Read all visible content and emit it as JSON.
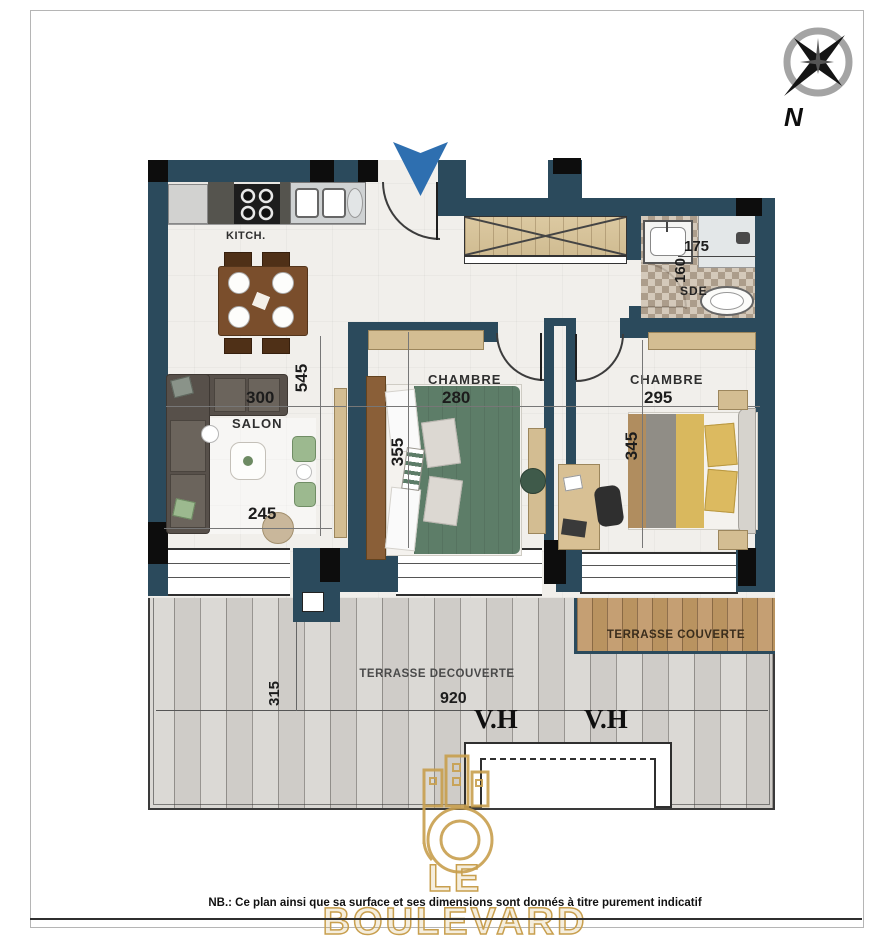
{
  "compass": {
    "north_label": "N"
  },
  "rooms": {
    "kitchen": {
      "label": "KITCH."
    },
    "salon": {
      "label": "SALON",
      "width": "300",
      "front": "245",
      "depth": "545"
    },
    "chambre1": {
      "label": "CHAMBRE",
      "width": "280",
      "depth": "355"
    },
    "chambre2": {
      "label": "CHAMBRE",
      "width": "295",
      "depth": "345"
    },
    "sde": {
      "label": "SDE",
      "width": "175",
      "depth": "160"
    },
    "terrasse_couverte": {
      "label": "TERRASSE COUVERTE"
    },
    "terrasse_decouverte": {
      "label": "TERRASSE DECOUVERTE",
      "width": "920",
      "depth": "315"
    }
  },
  "openings": {
    "vh_left": "V.H",
    "vh_right": "V.H"
  },
  "branding": {
    "name": "LE BOULEVARD"
  },
  "footer": {
    "note": "NB.: Ce plan ainsi que sa surface et ses dimensions sont donnés à titre purement indicatif"
  },
  "colors": {
    "wall": "#2b4a5c",
    "entrance_arrow": "#2e6fb0",
    "gold": "#c89f4e",
    "bed_green": "#5d7d68",
    "bed_yellow": "#d9b85e"
  }
}
